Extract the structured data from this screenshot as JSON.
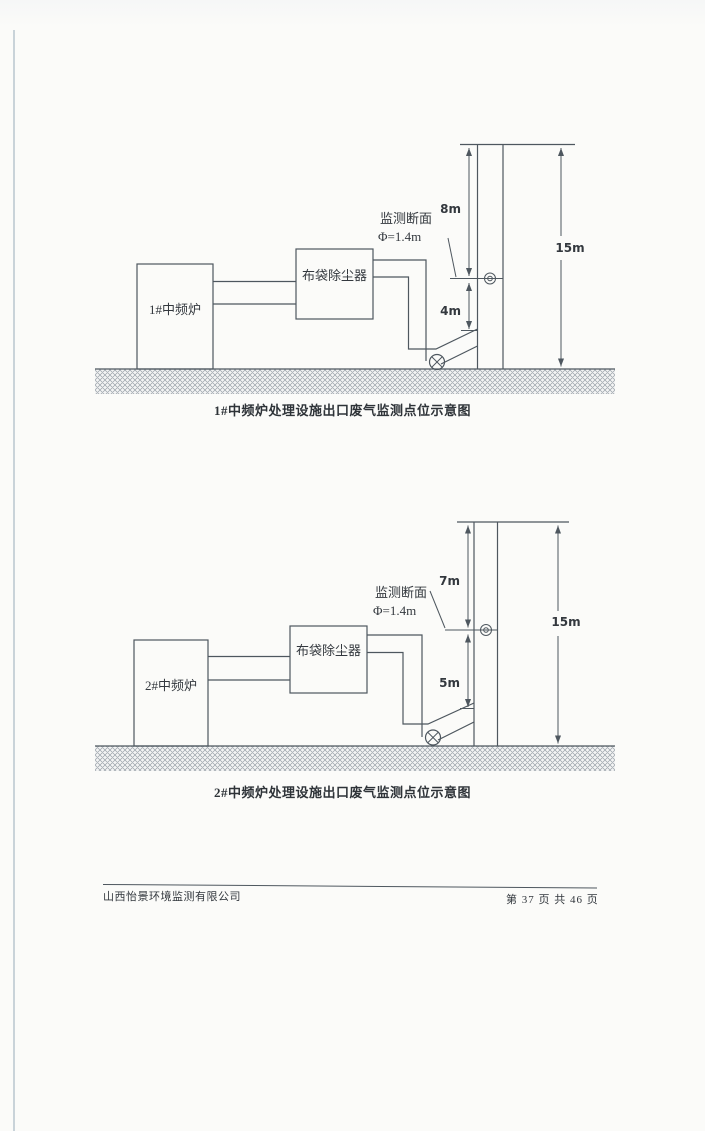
{
  "colors": {
    "paper": "#fbfbf9",
    "line": "#4e575f",
    "text": "#33383e",
    "caption": "#2e3338",
    "hatch": "#99a1a9",
    "scan_edge": "#c0cbd4"
  },
  "diagrams": [
    {
      "furnace": "1#中频炉",
      "collector": "布袋除尘器",
      "section_line1": "监测断面",
      "section_line2": "Φ=1.4m",
      "upper_dim": "8m",
      "lower_dim": "4m",
      "total_dim": "15m",
      "caption": "1#中频炉处理设施出口废气监测点位示意图"
    },
    {
      "furnace": "2#中频炉",
      "collector": "布袋除尘器",
      "section_line1": "监测断面",
      "section_line2": "Φ=1.4m",
      "upper_dim": "7m",
      "lower_dim": "5m",
      "total_dim": "15m",
      "caption": "2#中频炉处理设施出口废气监测点位示意图"
    }
  ],
  "footer": {
    "company": "山西怡景环境监测有限公司",
    "page_info": "第 37 页 共 46 页"
  }
}
